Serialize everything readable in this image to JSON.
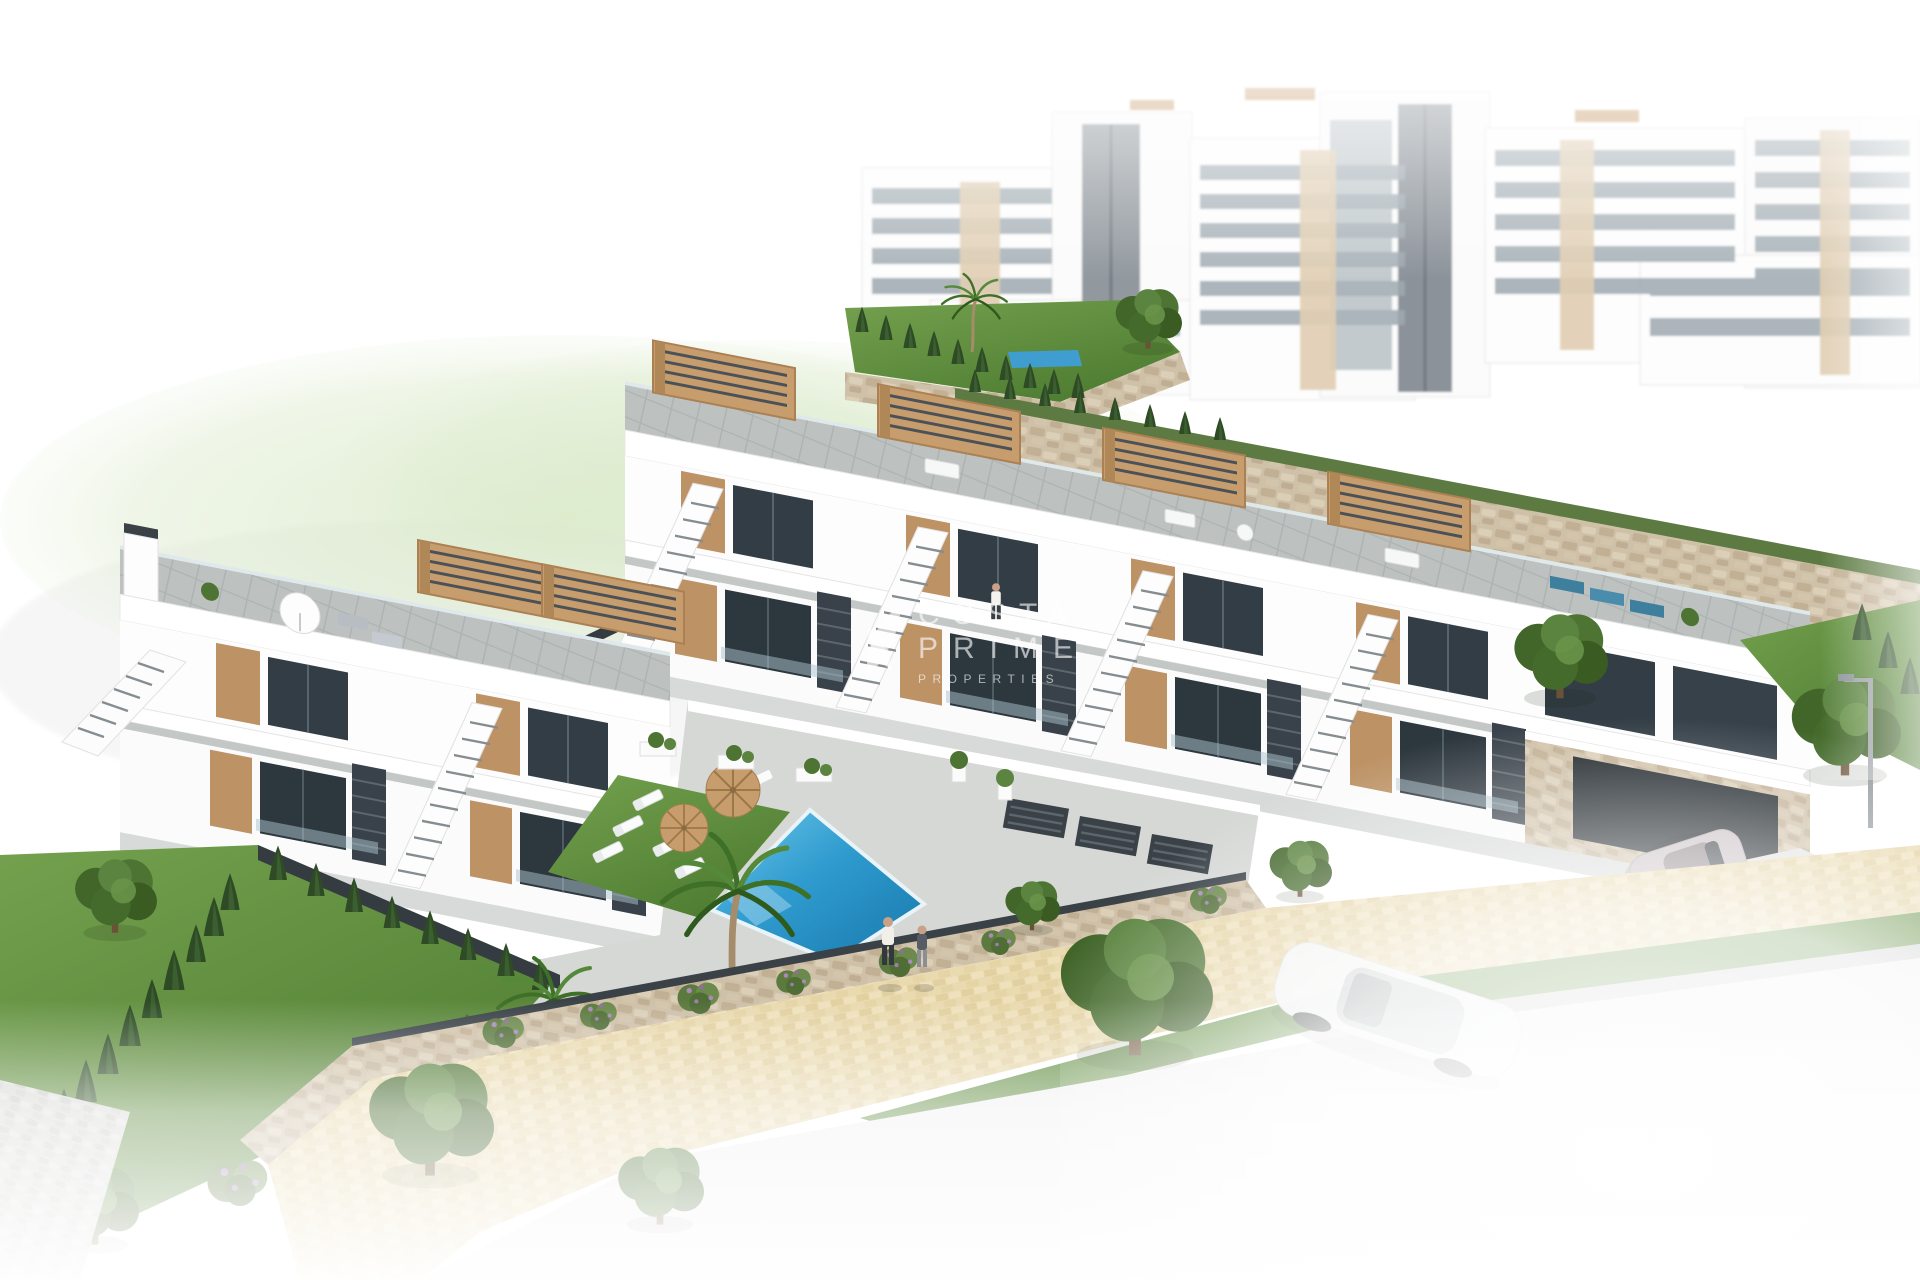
{
  "watermark": {
    "line1": "COSTA",
    "line2": "PRIME",
    "line3": "PROPERTIES",
    "icon": "palm-leaf-watermark-icon",
    "color": "#ffffff",
    "opacity": "0.62"
  },
  "scene": {
    "type": "architectural-3d-render",
    "subject": "aerial render of coastal residential development: two-storey townhouses with rooftop solariums and wooden pergolas, communal swimming pool with sun loungers and parasols, landscaped gardens, sand-coloured promenade, cars and background apartment blocks",
    "colors": {
      "background": "#ffffff",
      "pool_water_light": "#5fbde4",
      "pool_water_dark": "#1878ab",
      "lawn": "#5f8f3e",
      "pergola_wood": "#c79d6e",
      "window_glass": "#323d45",
      "roof_tile": "#bdc2c1",
      "stone_wall": "#cfc0a8",
      "sand_path": "#e9dab0",
      "dark_fence": "#3a4248",
      "conifer": "#2e4b25",
      "road": "#eef0ee"
    }
  }
}
